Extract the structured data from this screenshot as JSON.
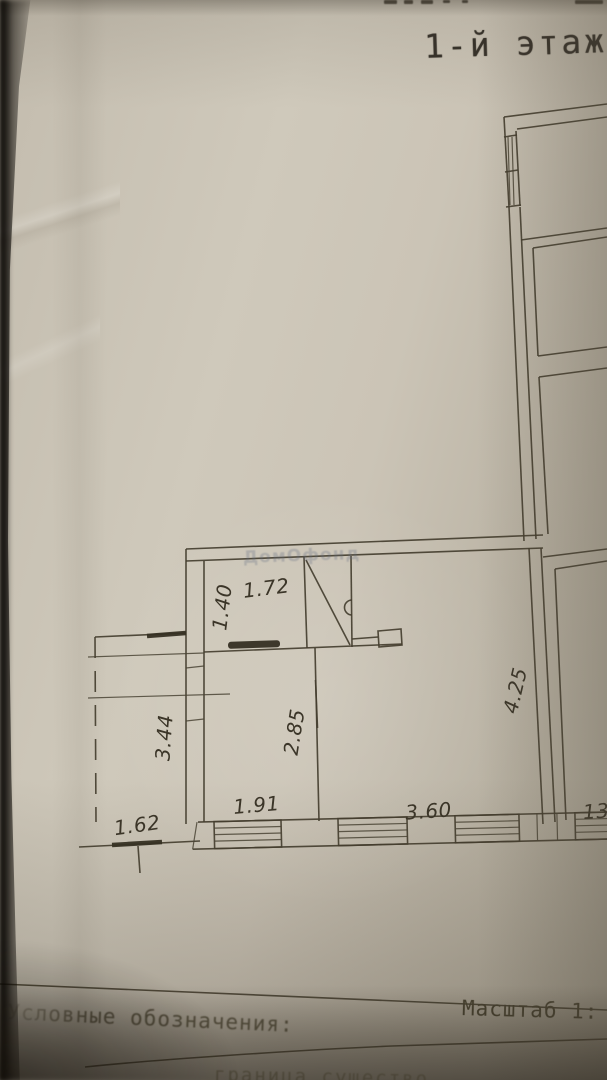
{
  "header": {
    "floor_title": "1-й этаж"
  },
  "watermark_text": "ДомОфонд",
  "plan": {
    "dims": {
      "closet_width": "1.72",
      "closet_depth": "1.40",
      "left_room_depth": "2.85",
      "left_room_width": "1.91",
      "main_room_width": "3.60",
      "main_room_depth": "4.25",
      "porch_depth": "3.44",
      "porch_width": "1.62",
      "right_room_partial": "13."
    }
  },
  "footer": {
    "legend_label": "Условные обозначения:",
    "scale_label": "Масштаб 1:",
    "bottom_cropped_text": "граница существо"
  }
}
